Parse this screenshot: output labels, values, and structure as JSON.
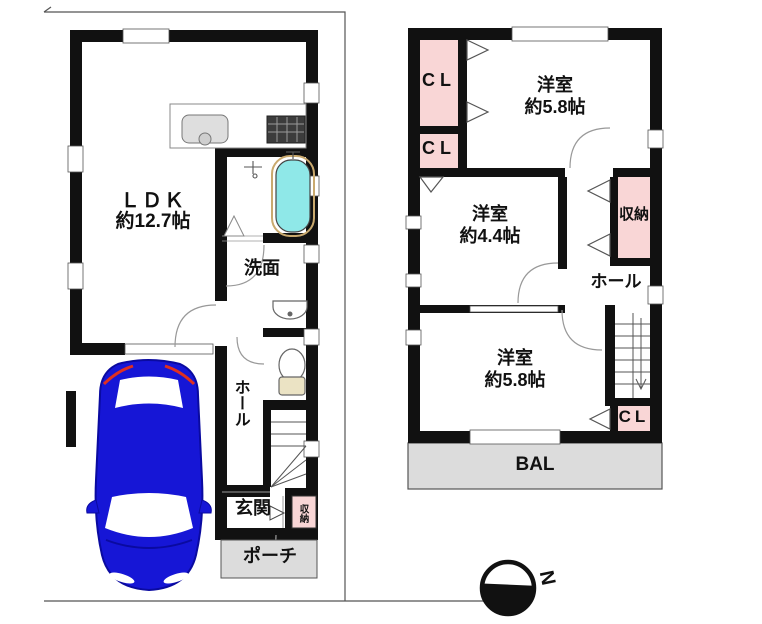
{
  "accent_colors": {
    "wall_black": "#111111",
    "closet_pink": "#f9d6d6",
    "balcony_gray": "#dcdcdc",
    "bathtub_cyan": "#8fe8e8",
    "car_blue": "#1616d6",
    "car_accent_red": "#e03020"
  },
  "floor1": {
    "ldk": {
      "name": "ＬＤＫ",
      "size": "約12.7帖"
    },
    "washroom": {
      "name": "洗面"
    },
    "hall": {
      "name": "ホール"
    },
    "entrance": {
      "name": "玄関"
    },
    "storage": {
      "name": "収納"
    },
    "porch": {
      "name": "ポーチ"
    }
  },
  "floor2": {
    "closet_top": {
      "name": "CL"
    },
    "closet_mid": {
      "name": "CL"
    },
    "room_ne": {
      "name": "洋室",
      "size": "約5.8帖"
    },
    "room_w": {
      "name": "洋室",
      "size": "約4.4帖"
    },
    "storage": {
      "name": "収納"
    },
    "hall": {
      "name": "ホール"
    },
    "room_s": {
      "name": "洋室",
      "size": "約5.8帖"
    },
    "closet_s": {
      "name": "CL"
    },
    "balcony": {
      "name": "BAL"
    }
  },
  "compass": {
    "north_label": "N"
  }
}
